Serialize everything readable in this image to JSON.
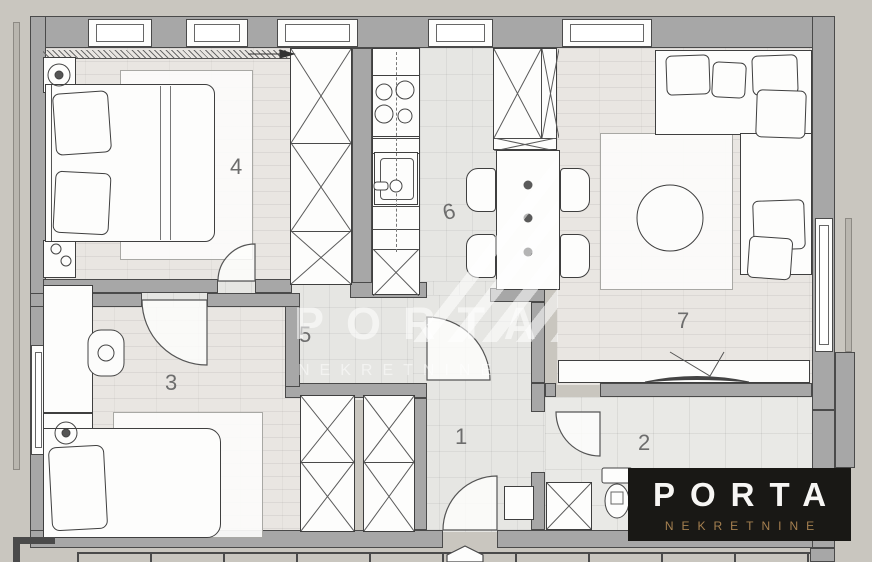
{
  "background": "#c9c6bf",
  "rooms": [
    {
      "id": 1,
      "name": "entrance-hall",
      "label": "1"
    },
    {
      "id": 2,
      "name": "bathroom",
      "label": "2"
    },
    {
      "id": 3,
      "name": "bedroom-2",
      "label": "3"
    },
    {
      "id": 4,
      "name": "bedroom-1",
      "label": "4"
    },
    {
      "id": 5,
      "name": "hallway",
      "label": "5"
    },
    {
      "id": 6,
      "name": "kitchen-dining",
      "label": "6"
    },
    {
      "id": 7,
      "name": "living-room",
      "label": "7"
    }
  ],
  "watermark": {
    "title": "PORTA",
    "subtitle": "NEKRETNINE"
  },
  "logo": {
    "title": "PORTA",
    "subtitle": "NEKRETNINE",
    "background": "#191815",
    "title_color": "#f7f6f4",
    "subtitle_color": "#a58050"
  },
  "colors": {
    "canvas_background": "#c9c6bf",
    "wall": "#a7a7a7",
    "wall_outline": "#4a4a4a",
    "floor_brick": "#e9e6e2",
    "floor_tile": "#e6e6e3",
    "furniture_fill": "#fdfdfc",
    "room_label": "#6d6d6d"
  },
  "icons": [
    "bed-icon",
    "pillow-icon",
    "lamp-icon",
    "wardrobe-x-icon",
    "stove-icon",
    "sink-icon",
    "dining-table-icon",
    "chair-icon",
    "sofa-icon",
    "coffee-table-icon",
    "tv-icon",
    "toilet-icon",
    "washing-machine-icon",
    "door-arc-icon",
    "window-icon",
    "radiator-icon",
    "entrance-marker-icon",
    "balcony-railing-icon"
  ]
}
